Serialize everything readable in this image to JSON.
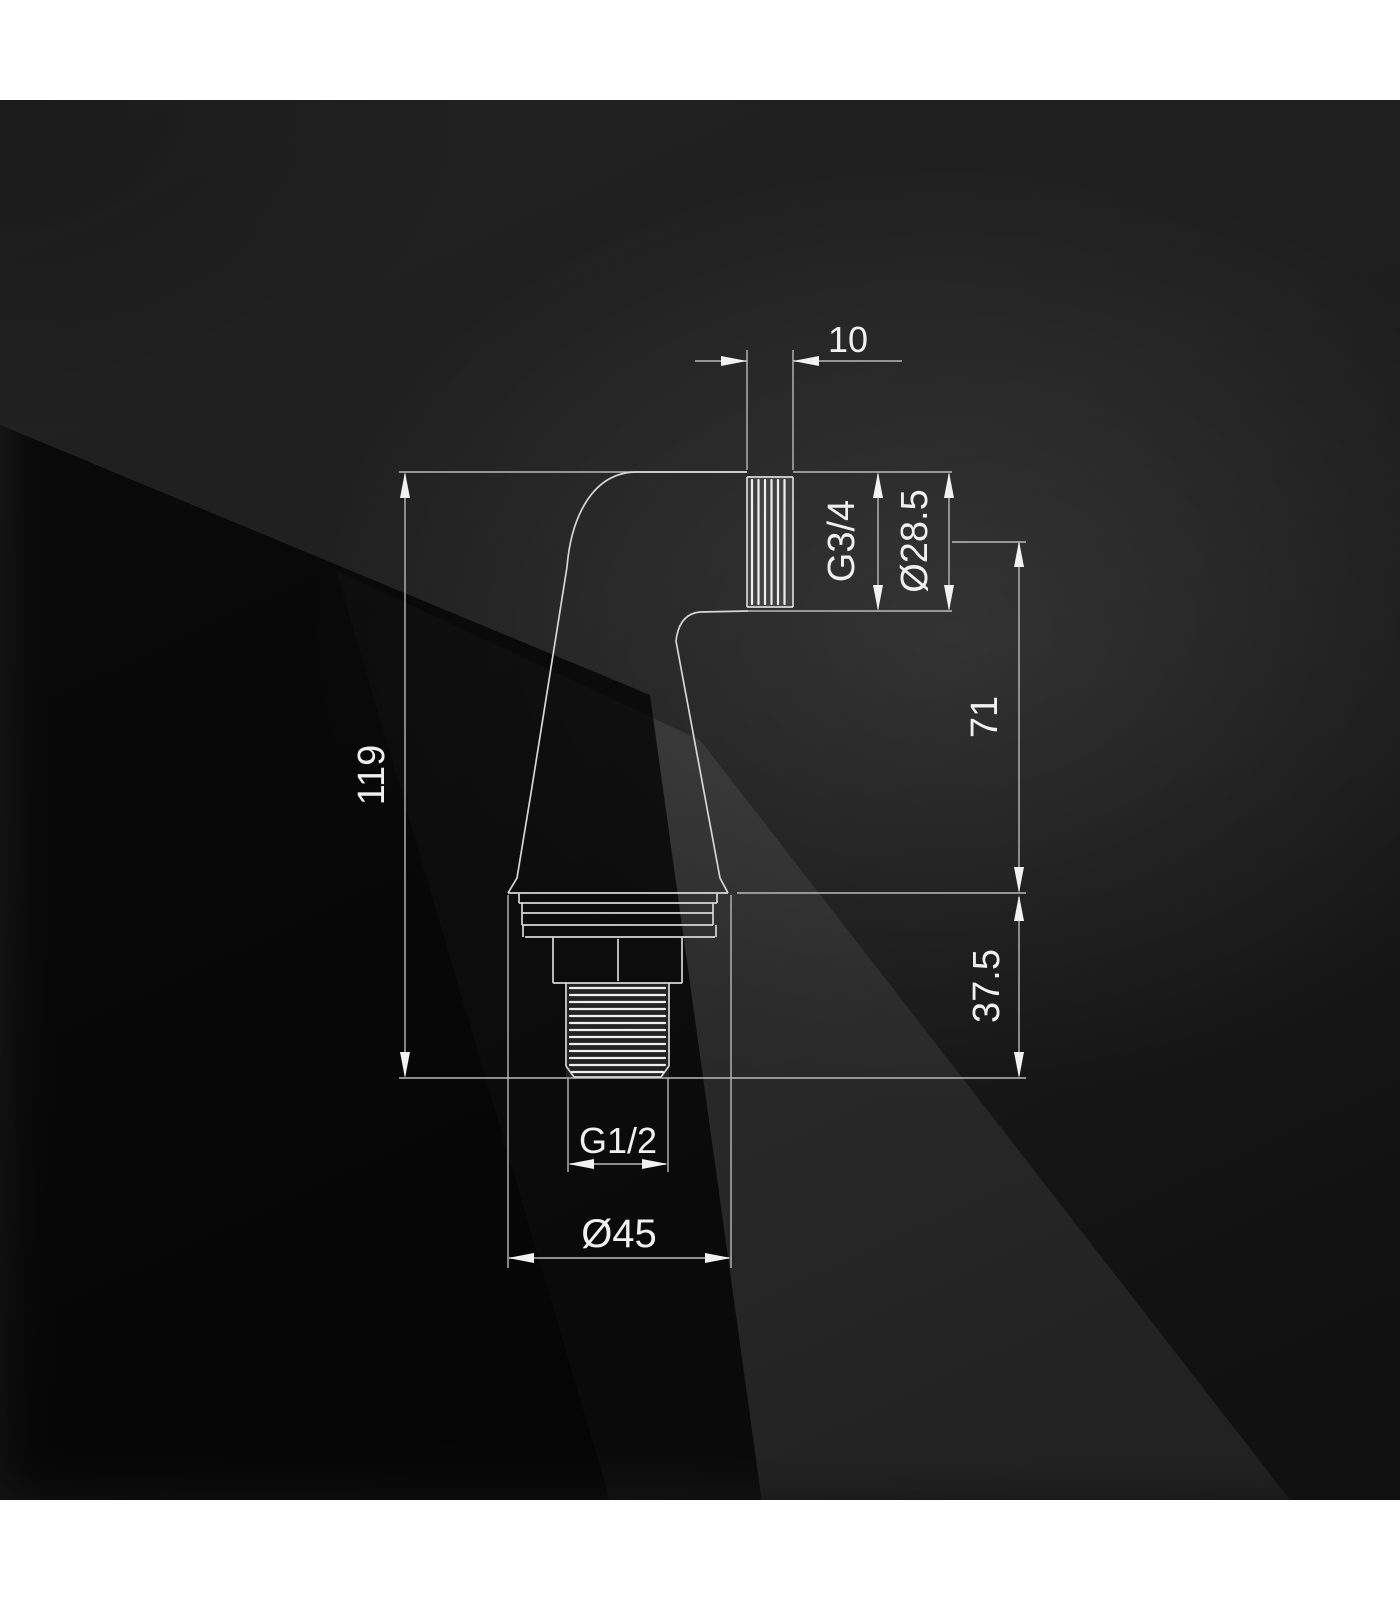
{
  "drawing": {
    "dimensions": {
      "outlet_thread_length": "10",
      "outlet_thread_size": "G3/4",
      "outlet_diameter": "Ø28.5",
      "outlet_axis_to_base": "71",
      "base_to_inlet_tip": "37.5",
      "overall_height": "119",
      "inlet_thread_size": "G1/2",
      "base_diameter": "Ø45"
    },
    "colors": {
      "page_band": "#ffffff",
      "background_base": "#1c1c1c",
      "line": "#b9b9b9",
      "outline": "#d6d6d6",
      "thread_ridge": "#efefef",
      "text": "#f0f0f0"
    }
  }
}
